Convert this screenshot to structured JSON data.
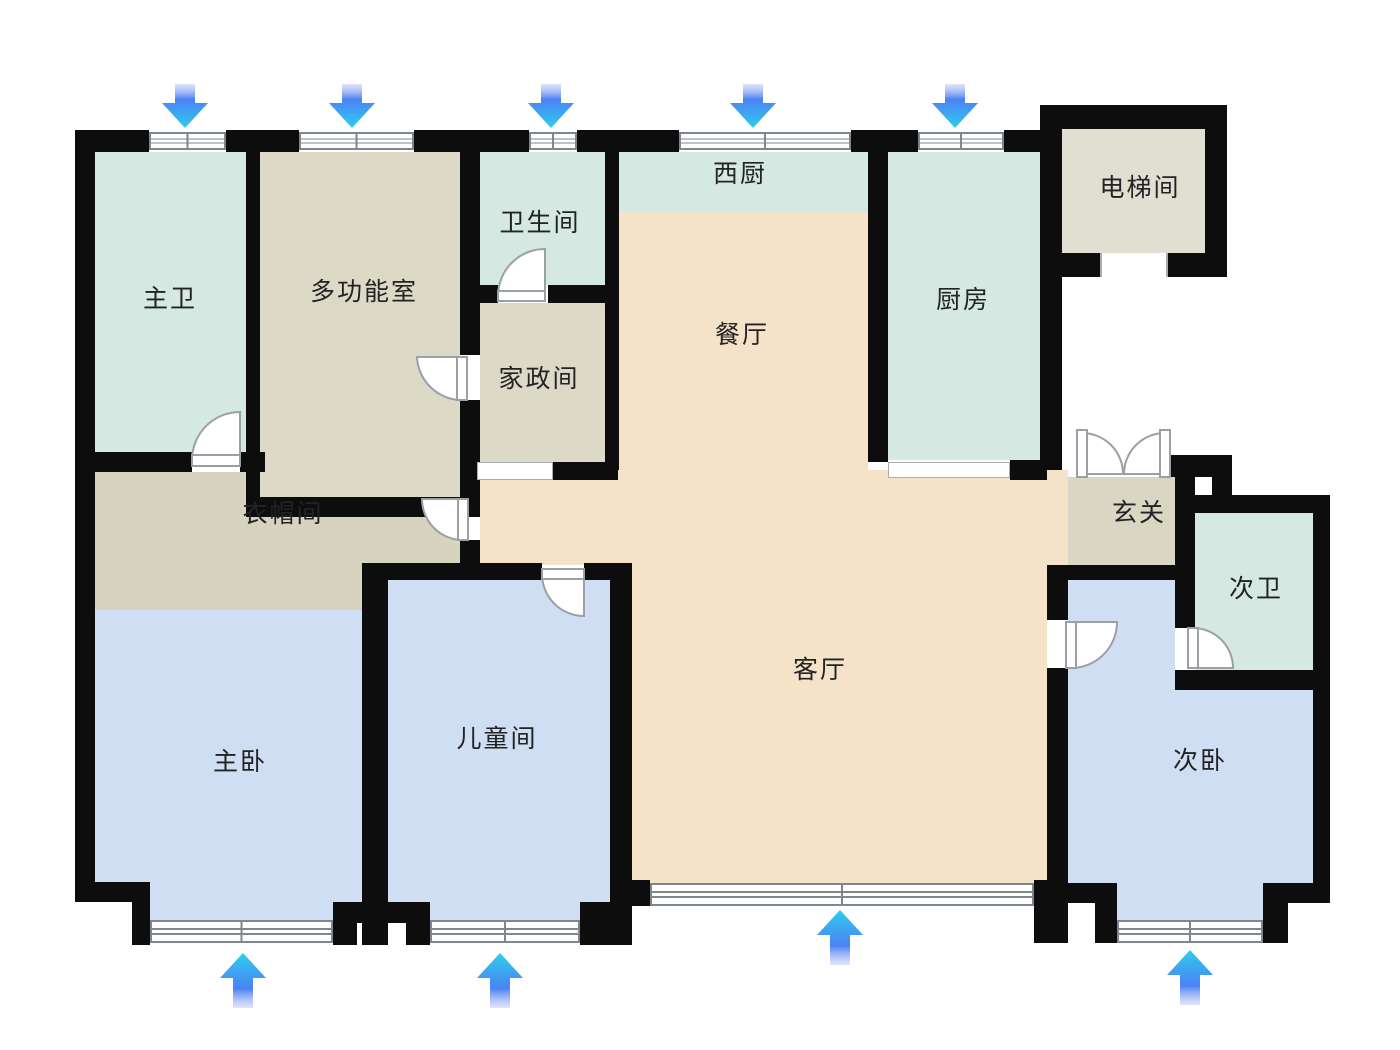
{
  "floorplan": {
    "title": "apartment-floor-plan",
    "rooms": [
      {
        "name": "master-bathroom",
        "label": "主卫",
        "color": "#d5e8e1"
      },
      {
        "name": "multifunction-room",
        "label": "多功能室",
        "color": "#dcd9c7"
      },
      {
        "name": "bathroom",
        "label": "卫生间",
        "color": "#d5e8e1"
      },
      {
        "name": "housekeeping-room",
        "label": "家政间",
        "color": "#dcd9c7"
      },
      {
        "name": "west-kitchen",
        "label": "西厨",
        "color": "#d5e8e1"
      },
      {
        "name": "dining-room",
        "label": "餐厅",
        "color": "#f4e3c8"
      },
      {
        "name": "kitchen",
        "label": "厨房",
        "color": "#d5e8e1"
      },
      {
        "name": "elevator-room",
        "label": "电梯间",
        "color": "#e0dfd2"
      },
      {
        "name": "cloakroom",
        "label": "衣帽间",
        "color": "#d6d3bf"
      },
      {
        "name": "entry-hall",
        "label": "玄关",
        "color": "#d9d6c4"
      },
      {
        "name": "second-bathroom",
        "label": "次卫",
        "color": "#d5e8e1"
      },
      {
        "name": "master-bedroom",
        "label": "主卧",
        "color": "#d0def4"
      },
      {
        "name": "children-room",
        "label": "儿童间",
        "color": "#d0def4"
      },
      {
        "name": "living-room",
        "label": "客厅",
        "color": "#f4e3c8"
      },
      {
        "name": "second-bedroom",
        "label": "次卧",
        "color": "#d0def4"
      }
    ],
    "arrows": {
      "top_count": 5,
      "top_direction": "down",
      "bottom_count": 4,
      "bottom_direction": "up",
      "gradient": [
        "#b9c2f7",
        "#4b82f4",
        "#2ecdee"
      ]
    },
    "wall_color": "#0d0d0d",
    "window_frame_color": "#7f868d",
    "door_color": "#9aa0a6",
    "background": "#ffffff"
  }
}
